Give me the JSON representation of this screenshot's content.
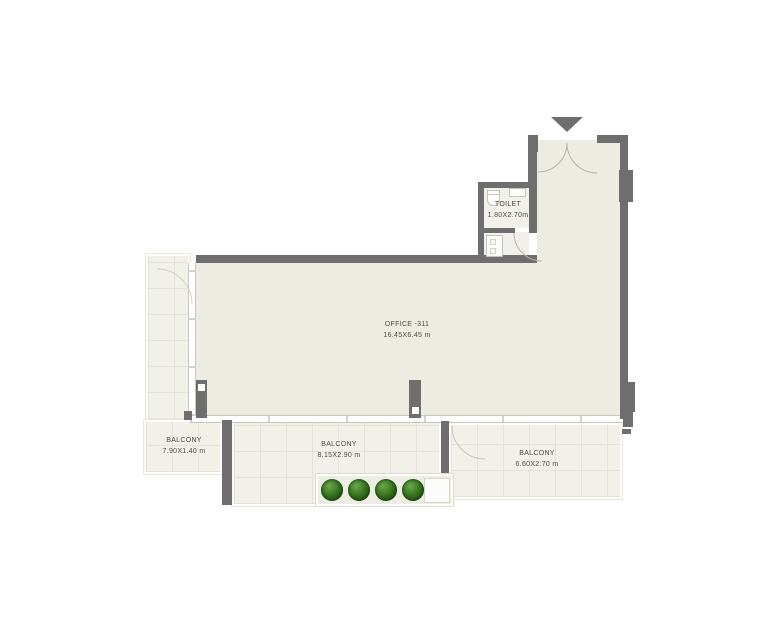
{
  "canvas": {
    "width": 780,
    "height": 640
  },
  "rooms": {
    "office": {
      "name": "OFFICE -311",
      "dims": "16.45X6.45 m"
    },
    "toilet": {
      "name": "TOILET",
      "dims": "1.80X2.70m"
    },
    "balcony_left": {
      "name": "BALCONY",
      "dims": "7.90X1.40 m"
    },
    "balcony_middle": {
      "name": "BALCONY",
      "dims": "8.15X2.90 m"
    },
    "balcony_right": {
      "name": "BALCONY",
      "dims": "6.60X2.70 m"
    }
  },
  "planter": {
    "plant_count": 4
  },
  "entry": {
    "marker": "triangle-down-arrow"
  },
  "colors": {
    "wall": "#6e6e6e",
    "office_floor": "#ecece2",
    "balcony_tile": "#f2f1e9",
    "tile_grid": "#e4e3d6",
    "plant_green": "#2f7025",
    "label_text": "#4c4c48",
    "background": "#ffffff"
  }
}
